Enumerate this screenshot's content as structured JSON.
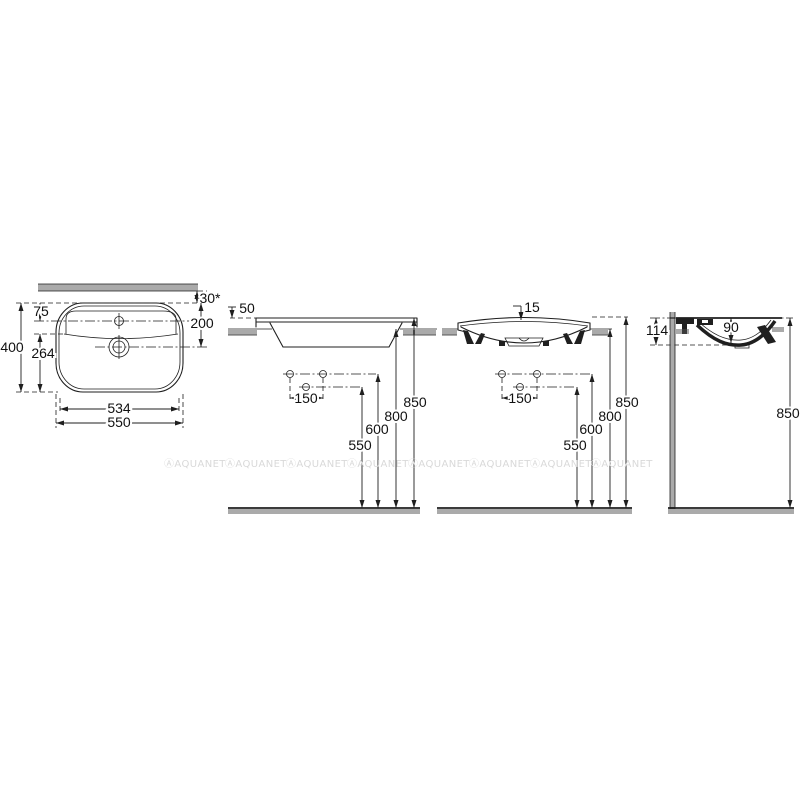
{
  "meta": {
    "background": "#ffffff",
    "line_color": "#1f1f1f",
    "text_color": "#111111",
    "drawing_type": "washbasin technical dimension drawing"
  },
  "watermark": {
    "text": "ⒶAQUANET",
    "color": "#d9d9d9",
    "count": 8
  },
  "plan_view": {
    "overall_depth": "400",
    "tap_setback": "75",
    "wall_gap": "30*",
    "drain_setback": "200",
    "front_depth": "264",
    "inner_width": "534",
    "overall_width": "550"
  },
  "side_view": {
    "rim_above_counter": "50",
    "fixing_hole_spacing": "150",
    "height_550": "550",
    "height_600": "600",
    "height_800": "800",
    "height_850": "850"
  },
  "front_view": {
    "rim_rise": "15",
    "fixing_hole_spacing": "150",
    "height_550": "550",
    "height_600": "600",
    "height_800": "800",
    "height_850": "850"
  },
  "section_view": {
    "basin_height": "114",
    "bowl_depth": "90",
    "height_850": "850"
  }
}
